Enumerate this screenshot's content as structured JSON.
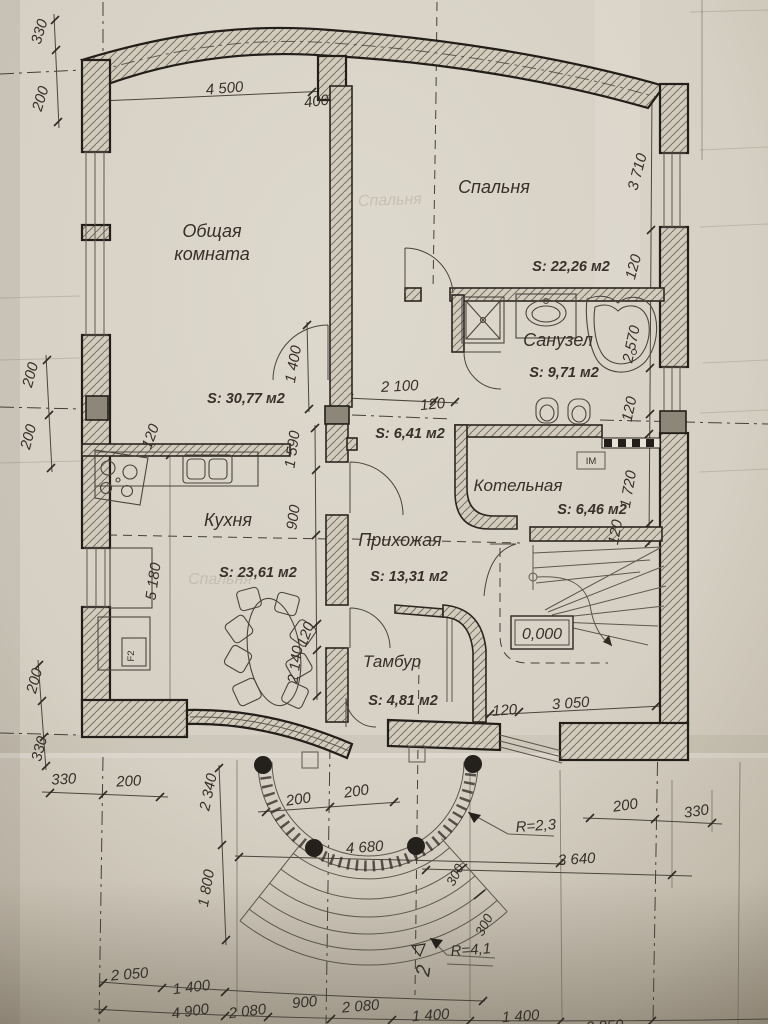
{
  "sheet": {
    "rooms": {
      "living": {
        "line1": "Общая",
        "line2": "комната",
        "area": "S: 30,77 м2"
      },
      "bedroom": {
        "name": "Спальня",
        "area": "S: 22,26 м2"
      },
      "bathroom": {
        "name": "Санузел",
        "area": "S: 9,71 м2"
      },
      "kitchen": {
        "name": "Кухня",
        "area": "S: 23,61 м2"
      },
      "hallway": {
        "name": "Прихожая",
        "area": "S: 13,31 м2"
      },
      "corridor": {
        "area": "S: 6,41 м2"
      },
      "boiler": {
        "name": "Котельная",
        "area": "S: 6,46 м2"
      },
      "vestibule": {
        "name": "Тамбур",
        "area": "S: 4,81 м2"
      }
    },
    "marks": {
      "level": "0,000",
      "im": "IM",
      "f2": "F2",
      "section_number": "2",
      "porch_radius": "R=2,3",
      "steps_radius": "R=4,1"
    },
    "dims": {
      "top_w1": "4 500",
      "top_w2": "400",
      "lt_a": "330",
      "lt_b": "200",
      "lm_a": "200",
      "lm_b": "200",
      "ll_a": "200",
      "ll_b": "330",
      "blh_a": "330",
      "blh_b": "200",
      "v2340": "2 340",
      "v1800": "1 800",
      "row1_a": "2 050",
      "row1_b": "1 400",
      "row2_a": "4 900",
      "row2_b": "2 080",
      "row2_c": "900",
      "row2_d": "2 080",
      "row2_e": "1 400",
      "row2_f": "1 400",
      "row2_g": "2 850",
      "brh_a": "200",
      "brh_b": "330",
      "br_3640": "3 640",
      "porch_a": "200",
      "porch_b": "200",
      "porch_w": "4 680",
      "step_a": "300",
      "step_b": "300",
      "rv_3710": "3 710",
      "rv_120a": "120",
      "rv_2570": "2 570",
      "rv_120b": "120",
      "rv_1720": "1 720",
      "rv_120c": "120",
      "c_1400": "1 400",
      "c_2100": "2 100",
      "c_120": "120",
      "mv_1590": "1 590",
      "mv_900": "900",
      "mv_2140": "2 140",
      "mv_120": "120",
      "k_120": "120",
      "k_5180": "5 180",
      "st_120": "120",
      "st_3050": "3 050"
    },
    "ghost": {
      "a": "Спальня",
      "b": "Спальня"
    }
  }
}
